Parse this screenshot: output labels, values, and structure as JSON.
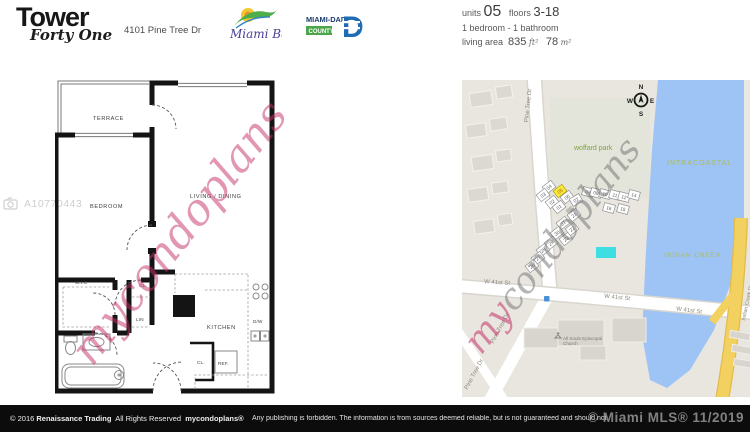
{
  "header": {
    "logo_title": "Tower",
    "logo_subtitle": "Forty One",
    "address": "4101 Pine Tree Dr",
    "miami_beach_logo_text": "Miami Beach",
    "miami_dade_line1": "MIAMI-DADE",
    "miami_dade_line2": "COUNTY",
    "miami_dade_letter": "D",
    "unit_info": {
      "units_label": "units",
      "units_value": "05",
      "floors_label": "floors",
      "floors_value": "3-18",
      "bed_bath": "1 bedroom - 1 bathroom",
      "living_area_label": "living area",
      "sqft_value": "835",
      "sqft_unit": "ft²",
      "m2_value": "78",
      "m2_unit": "m²"
    }
  },
  "floorplan": {
    "photo_id": "A10770443",
    "watermark": "mycondoplans",
    "rooms": {
      "terrace": "TERRACE",
      "bedroom": "BEDROOM",
      "living": "LIVING / DINING",
      "wic": "W.I.C",
      "closet1": "CL.",
      "linen": "LIN",
      "kitchen": "KITCHEN",
      "dishwasher": "D/W",
      "closet2": "CL.",
      "refrigerator": "REF."
    }
  },
  "map": {
    "watermark_part1": "my",
    "watermark_part2": "condoplans",
    "labels": {
      "park": "woffard park",
      "intracoastal": "INTRACOASTAL",
      "indian_creek": "INDIAN CREEK",
      "pine_tree_dr": "Pine Tree Dr",
      "w_41st_st": "W 41st St",
      "indian_creek_dr": "Indian Creek Dr",
      "church": "All Souls Episcopal Church"
    },
    "compass": {
      "n": "N",
      "s": "S",
      "e": "E",
      "w": "W"
    },
    "highlighted_unit": "05",
    "units": [
      {
        "n": "04",
        "x": 87,
        "y": 107,
        "r": -38
      },
      {
        "n": "05",
        "x": 98,
        "y": 111,
        "r": -38,
        "hl": true
      },
      {
        "n": "03",
        "x": 81,
        "y": 115,
        "r": -38
      },
      {
        "n": "02",
        "x": 90,
        "y": 122,
        "r": -38
      },
      {
        "n": "06",
        "x": 105,
        "y": 117,
        "r": -38
      },
      {
        "n": "01",
        "x": 97,
        "y": 127,
        "r": -38
      },
      {
        "n": "07",
        "x": 114,
        "y": 120,
        "r": -30
      },
      {
        "n": "08",
        "x": 126,
        "y": 112,
        "r": 15
      },
      {
        "n": "09",
        "x": 134,
        "y": 113,
        "r": 15
      },
      {
        "n": "10",
        "x": 143,
        "y": 114,
        "r": 15
      },
      {
        "n": "11",
        "x": 153,
        "y": 115,
        "r": 15
      },
      {
        "n": "12",
        "x": 162,
        "y": 117,
        "r": 15
      },
      {
        "n": "14",
        "x": 172,
        "y": 115,
        "r": 15
      },
      {
        "n": "16",
        "x": 147,
        "y": 128,
        "r": 15
      },
      {
        "n": "15",
        "x": 161,
        "y": 129,
        "r": 15
      },
      {
        "n": "21",
        "x": 112,
        "y": 135,
        "r": -38
      },
      {
        "n": "31",
        "x": 101,
        "y": 143,
        "r": -38
      },
      {
        "n": "22",
        "x": 110,
        "y": 149,
        "r": -38
      },
      {
        "n": "30",
        "x": 95,
        "y": 153,
        "r": -38
      },
      {
        "n": "23",
        "x": 104,
        "y": 159,
        "r": -38
      },
      {
        "n": "29",
        "x": 89,
        "y": 163,
        "r": -38
      },
      {
        "n": "28",
        "x": 81,
        "y": 170,
        "r": -38
      },
      {
        "n": "27",
        "x": 76,
        "y": 178,
        "r": -38
      },
      {
        "n": "26",
        "x": 70,
        "y": 186,
        "r": -38
      }
    ],
    "colors": {
      "background": "#e9e6e0",
      "water": "#9ec3f5",
      "road": "#ffffff",
      "highway": "#f3d160",
      "highlight_unit": "#f8e93e",
      "pool": "#3fdee2"
    }
  },
  "footer": {
    "copyright": "© 2016",
    "company": "Renaissance Trading",
    "rights": "All Rights Reserved",
    "brand": "mycondoplans®",
    "notice": "Any publishing is forbidden.  The information is from sources deemed reliable, but is not guaranteed and should not",
    "mls_overlay": "© Miami MLS® 11/2019"
  }
}
